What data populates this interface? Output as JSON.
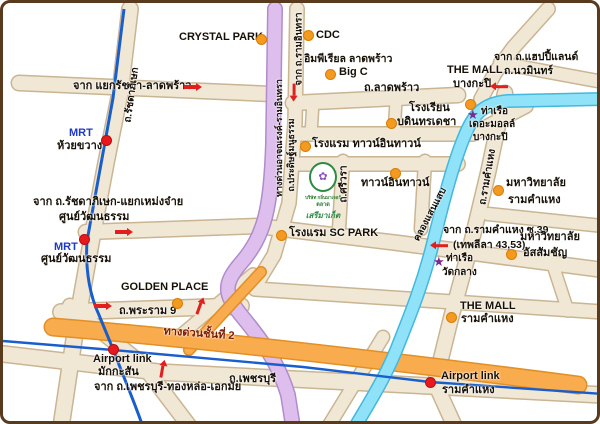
{
  "map": {
    "width": 600,
    "height": 424
  },
  "colors": {
    "road_fill": "#F0E7D5",
    "road_border": "#C9B593",
    "expressway_purple": "#DDBEEC",
    "expressway_purple_border": "#B08CCB",
    "expressway_orange": "#F9AC4E",
    "expressway_orange_border": "#E28F25",
    "canal_fill": "#8FE2F7",
    "canal_border": "#44B8DC",
    "transit_blue": "#1A5ECC",
    "marker_orange": "#F49A20",
    "marker_red": "#E8191C",
    "pier_purple": "#7B2B8F",
    "text": "#171007",
    "mrt": "#2038C8",
    "exp": "#7A1B00",
    "map_border": "#5A3A1C",
    "background": "#FFFFFF"
  },
  "labels": [
    {
      "name": "label-crystal-park",
      "text": "CRYSTAL PARK",
      "x": 176,
      "y": 28
    },
    {
      "name": "label-cdc",
      "text": "CDC",
      "x": 313,
      "y": 26
    },
    {
      "name": "label-imperial-ladprao",
      "text": "อิมพีเรียล ลาดพร้าว",
      "x": 301,
      "y": 50,
      "size": 10.5
    },
    {
      "name": "label-big-c",
      "text": "Big C",
      "x": 336,
      "y": 63
    },
    {
      "name": "label-ladprao-road",
      "text": "ถ.ลาดพร้าว",
      "x": 361,
      "y": 79
    },
    {
      "name": "label-the-mall-bangkapi-1",
      "text": "THE MALL",
      "x": 444,
      "y": 61
    },
    {
      "name": "label-the-mall-bangkapi-2",
      "text": "บางกะปิ",
      "x": 450,
      "y": 75
    },
    {
      "name": "label-from-happyland-1",
      "text": "จาก ถ.แฮปปี้แลนด์",
      "x": 491,
      "y": 48,
      "size": 10.5
    },
    {
      "name": "label-from-happyland-2",
      "text": "ถ.นวมินทร์",
      "x": 501,
      "y": 62,
      "size": 10.5
    },
    {
      "name": "label-from-ratchada-ladprao",
      "text": "จาก แยกรัชดา-ลาดพร้าว",
      "x": 70,
      "y": 77
    },
    {
      "name": "label-bodindecha-school-1",
      "text": "โรงเรียน",
      "x": 406,
      "y": 99
    },
    {
      "name": "label-bodindecha-school-2",
      "text": "บดินทรเดชา",
      "x": 394,
      "y": 113
    },
    {
      "name": "label-pier-the-mall-1",
      "text": "ท่าเรือ",
      "x": 478,
      "y": 103,
      "size": 10
    },
    {
      "name": "label-pier-the-mall-2",
      "text": "เดอะมอลล์",
      "x": 466,
      "y": 116,
      "size": 10
    },
    {
      "name": "label-pier-the-mall-3",
      "text": "บางกะปิ",
      "x": 470,
      "y": 129,
      "size": 10
    },
    {
      "name": "label-hotel-town-in-town",
      "text": "โรงแรม ทาวน์อินทาวน์",
      "x": 309,
      "y": 135
    },
    {
      "name": "label-town-in-town",
      "text": "ทาวน์อินทาวน์",
      "x": 358,
      "y": 174
    },
    {
      "name": "label-ramkhamhaeng-univ-1",
      "text": "มหาวิทยาลัย",
      "x": 503,
      "y": 174
    },
    {
      "name": "label-ramkhamhaeng-univ-2",
      "text": "รามคำแหง",
      "x": 505,
      "y": 191
    },
    {
      "name": "label-from-ram39-1",
      "text": "จาก ถ.รามคำแหง ซ.39",
      "x": 440,
      "y": 221,
      "size": 10.5
    },
    {
      "name": "label-from-ram39-2",
      "text": "(เทพลีลา 43,53)",
      "x": 450,
      "y": 236,
      "size": 10.5
    },
    {
      "name": "label-assumption-univ-1",
      "text": "มหาวิทยาลัย",
      "x": 517,
      "y": 228
    },
    {
      "name": "label-assumption-univ-2",
      "text": "อัสสัมชัญ",
      "x": 520,
      "y": 244
    },
    {
      "name": "label-pier-watklang-1",
      "text": "ท่าเรือ",
      "x": 443,
      "y": 250,
      "size": 10
    },
    {
      "name": "label-pier-watklang-2",
      "text": "วัดกลาง",
      "x": 439,
      "y": 264,
      "size": 10
    },
    {
      "name": "label-the-mall-ram-1",
      "text": "THE MALL",
      "x": 457,
      "y": 297
    },
    {
      "name": "label-the-mall-ram-2",
      "text": "รามคำแหง",
      "x": 458,
      "y": 310
    },
    {
      "name": "label-airport-link-ram-1",
      "text": "Airport link",
      "x": 438,
      "y": 367
    },
    {
      "name": "label-airport-link-ram-2",
      "text": "รามคำแหง",
      "x": 439,
      "y": 381
    },
    {
      "name": "label-sc-park-hotel",
      "text": "โรงแรม SC PARK",
      "x": 286,
      "y": 224
    },
    {
      "name": "label-from-mengjai-1",
      "text": "จาก ถ.รัชดาภิเษก-แยกเหม่งจ๋าย",
      "x": 30,
      "y": 193
    },
    {
      "name": "label-from-mengjai-2",
      "text": "ศูนย์วัฒนธรรม",
      "x": 56,
      "y": 208
    },
    {
      "name": "label-mrt-huaikhwang-1",
      "text": "MRT",
      "x": 66,
      "y": 124,
      "color": "mrt"
    },
    {
      "name": "label-mrt-huaikhwang-2",
      "text": "ห้วยขวาง",
      "x": 54,
      "y": 137
    },
    {
      "name": "label-mrt-culture-1",
      "text": "MRT",
      "x": 51,
      "y": 238,
      "color": "mrt"
    },
    {
      "name": "label-mrt-culture-2",
      "text": "ศูนย์วัฒนธรรม",
      "x": 38,
      "y": 250
    },
    {
      "name": "label-golden-place",
      "text": "GOLDEN PLACE",
      "x": 118,
      "y": 278
    },
    {
      "name": "label-rama9-road",
      "text": "ถ.พระราม 9",
      "x": 116,
      "y": 302
    },
    {
      "name": "label-expressway-2nd-stage",
      "text": "ทางด่วนชั้นที่ 2",
      "x": 196,
      "y": 331,
      "color": "exp",
      "rot": 4
    },
    {
      "name": "label-phetchaburi-road",
      "text": "ถ.เพชรบุรี",
      "x": 226,
      "y": 370
    },
    {
      "name": "label-airport-link-makkasan-1",
      "text": "Airport link",
      "x": 90,
      "y": 350
    },
    {
      "name": "label-airport-link-makkasan-2",
      "text": "มักกะสัน",
      "x": 95,
      "y": 363
    },
    {
      "name": "label-from-phetchaburi",
      "text": "จาก ถ.เพชรบุรี-ทองหล่อ-เอกมัย",
      "x": 91,
      "y": 378
    },
    {
      "name": "label-ratchadaphisek-road",
      "text": "ถ.รัชดาภิเษก",
      "x": 129,
      "y": 92,
      "rot": -82,
      "size": 10
    },
    {
      "name": "label-expressway-atnarong",
      "text": "ทางด่วนอาจณรงค์-รามอินทรา",
      "x": 276,
      "y": 135,
      "rot": -90,
      "size": 9
    },
    {
      "name": "label-from-raminthra",
      "text": "จาก ถ.รามอินทรา",
      "x": 297,
      "y": 46,
      "rot": -90,
      "size": 9.5
    },
    {
      "name": "label-pradit-manutham-road",
      "text": "ถ.ประดิษฐ์มนูธรรม",
      "x": 288,
      "y": 152,
      "rot": -90,
      "size": 9
    },
    {
      "name": "label-srivara-road",
      "text": "ถ.ศรีวรา",
      "x": 341,
      "y": 181,
      "rot": -90,
      "size": 10
    },
    {
      "name": "label-ramkhamhaeng-road",
      "text": "ถ.รามคำแหง",
      "x": 485,
      "y": 174,
      "rot": -80,
      "size": 10
    },
    {
      "name": "label-khlong-saen-saep",
      "text": "คลองแสนแสบ",
      "x": 428,
      "y": 212,
      "rot": -62,
      "size": 9.5
    }
  ],
  "dots": [
    {
      "name": "marker-crystal-park",
      "x": 258,
      "y": 36,
      "type": "poi"
    },
    {
      "name": "marker-cdc",
      "x": 305,
      "y": 32,
      "type": "poi"
    },
    {
      "name": "marker-big-c",
      "x": 327,
      "y": 71,
      "type": "poi"
    },
    {
      "name": "marker-the-mall-bangkapi",
      "x": 467,
      "y": 101,
      "type": "poi"
    },
    {
      "name": "marker-bodindecha-school",
      "x": 388,
      "y": 120,
      "type": "poi"
    },
    {
      "name": "marker-hotel-town-in-town",
      "x": 302,
      "y": 143,
      "type": "poi"
    },
    {
      "name": "marker-town-in-town",
      "x": 392,
      "y": 170,
      "type": "poi"
    },
    {
      "name": "marker-ramkhamhaeng-univ",
      "x": 495,
      "y": 187,
      "type": "poi"
    },
    {
      "name": "marker-assumption-univ",
      "x": 508,
      "y": 251,
      "type": "poi"
    },
    {
      "name": "marker-the-mall-ram",
      "x": 448,
      "y": 314,
      "type": "poi"
    },
    {
      "name": "marker-sc-park",
      "x": 278,
      "y": 232,
      "type": "poi"
    },
    {
      "name": "marker-golden-place",
      "x": 174,
      "y": 300,
      "type": "poi"
    },
    {
      "name": "marker-mrt-huaikhwang",
      "x": 103,
      "y": 137,
      "type": "stn"
    },
    {
      "name": "marker-mrt-culture-centre",
      "x": 81,
      "y": 236,
      "type": "stn"
    },
    {
      "name": "marker-airport-link-makkasan",
      "x": 110,
      "y": 346,
      "type": "stn"
    },
    {
      "name": "marker-airport-link-ram",
      "x": 427,
      "y": 379,
      "type": "stn"
    }
  ],
  "stars": [
    {
      "name": "pier-the-mall-star-icon",
      "x": 470,
      "y": 112,
      "icon": "★"
    },
    {
      "name": "pier-watklang-star-icon",
      "x": 436,
      "y": 259,
      "icon": "★"
    }
  ],
  "arrows": [
    {
      "name": "arrow-right-ladprao-icon",
      "x": 187,
      "y": 84,
      "dir": "right"
    },
    {
      "name": "arrow-down-raminthra-icon",
      "x": 291,
      "y": 87,
      "dir": "down"
    },
    {
      "name": "arrow-left-mall-bangkapi-icon",
      "x": 499,
      "y": 84,
      "dir": "left"
    },
    {
      "name": "arrow-right-mengjai-icon",
      "x": 118,
      "y": 229,
      "dir": "right"
    },
    {
      "name": "arrow-left-ram39-icon",
      "x": 439,
      "y": 243,
      "dir": "left"
    },
    {
      "name": "arrow-right-rama9-icon",
      "x": 97,
      "y": 303,
      "dir": "right"
    },
    {
      "name": "arrow-up-junction-icon",
      "x": 196,
      "y": 306,
      "dir": "up",
      "rot": 20
    },
    {
      "name": "arrow-up-phetchaburi-icon",
      "x": 159,
      "y": 369,
      "dir": "up",
      "rot": 10
    }
  ],
  "logo": {
    "flower_icon": "✿",
    "line1": "บริษัท กลิ่นมาเจอร์",
    "line2": "ตลาด",
    "line3": "เสรีมาเก็ต"
  }
}
